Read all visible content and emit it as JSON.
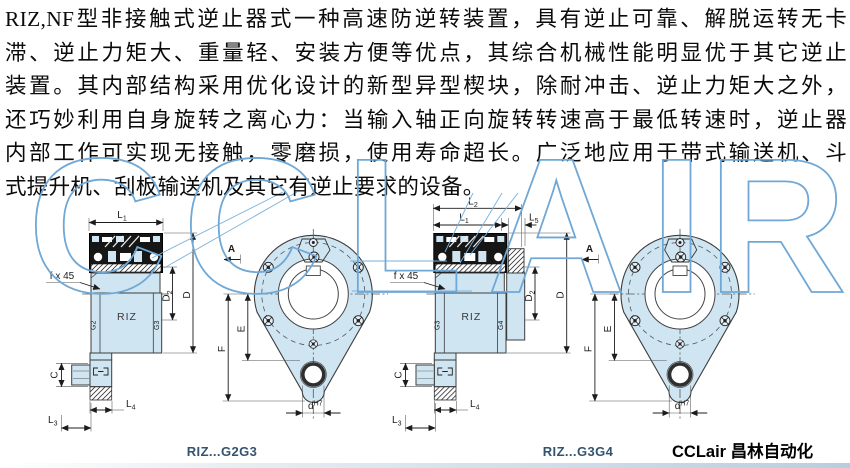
{
  "intro": {
    "lines": [
      "RIZ,NF型非接触式逆止器式一种高速防逆转装置，具有逆止可靠、解脱运转无卡",
      "滞、逆止力矩大、重量轻、安装方便等优点，其综合机械性能明显优于其它逆止",
      "装置。其内部结构采用优化设计的新型异型楔块，除耐冲击、逆止力矩大之外，",
      "还巧妙利用自身旋转之离心力：当输入轴正向旋转转速高于最低转速时，逆止器",
      "内部工作可实现无接触，零磨损，使用寿命超长。广泛地应用于带式输送机、斗",
      "式提升机、刮板输送机及其它有逆止要求的设备。"
    ]
  },
  "watermark": {
    "letters": [
      "C",
      "C",
      "L",
      "A",
      "I",
      "R"
    ],
    "color": "#6fa8d6"
  },
  "dims": {
    "l1": {
      "m": "L",
      "s": "1"
    },
    "l2": {
      "m": "L",
      "s": "2"
    },
    "l3": {
      "m": "L",
      "s": "3"
    },
    "l4": {
      "m": "L",
      "s": "4"
    },
    "l5": {
      "m": "L",
      "s": "5"
    },
    "d2": {
      "m": "D",
      "s": "2"
    },
    "d": "D",
    "e": "E",
    "f": "F",
    "c": "C",
    "a": "A",
    "fx45": "f x 45",
    "dh7": {
      "m": "d",
      "sup": "H7"
    },
    "riz": "RIZ",
    "g2": "G2",
    "g3": "G3",
    "g4": "G4"
  },
  "captions": {
    "left": "RIZ...G2G3",
    "right": "RIZ...G3G4",
    "brand": "CCLair 昌林自动化"
  },
  "colors": {
    "fill": "#cfe5f2",
    "line": "#333333",
    "watermark": "#6fa8d6",
    "caption": "#33536f"
  }
}
